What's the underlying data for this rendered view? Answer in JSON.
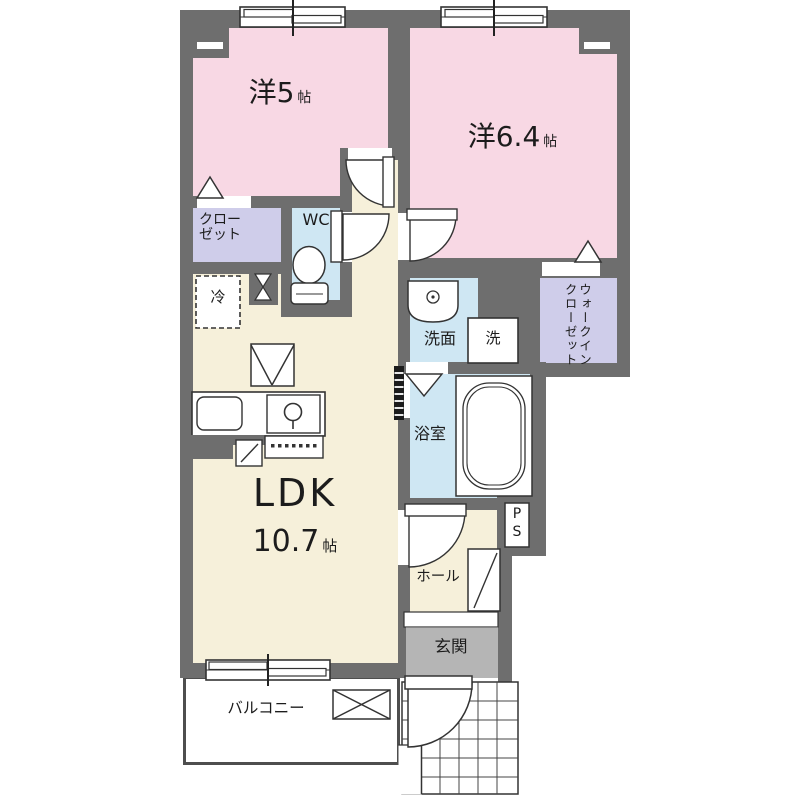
{
  "colors": {
    "wall": "#6e6e6e",
    "western_room": "#f8d8e4",
    "closet": "#cfcdea",
    "wet_area": "#cfe7f3",
    "ldk": "#f6f0da",
    "entrance_floor": "#b5b5b5",
    "outline": "#333333"
  },
  "rooms": {
    "bedroom_a": {
      "name": "洋5",
      "unit": "帖"
    },
    "bedroom_b": {
      "name": "洋6.4",
      "unit": "帖"
    },
    "closet": {
      "label": "クローゼット"
    },
    "wc": {
      "label": "WC"
    },
    "refrigerator": {
      "label": "冷"
    },
    "washroom": {
      "label": "洗面"
    },
    "washing_machine": {
      "label": "洗"
    },
    "bathroom": {
      "label": "浴室"
    },
    "walk_in_closet": {
      "label": "ウォークインクローゼット"
    },
    "ldk": {
      "name": "LDK",
      "size": "10.7",
      "unit": "帖"
    },
    "hall": {
      "label": "ホール"
    },
    "pipe_space": {
      "label": "PS"
    },
    "entrance": {
      "label": "玄関"
    },
    "balcony": {
      "label": "バルコニー"
    }
  }
}
